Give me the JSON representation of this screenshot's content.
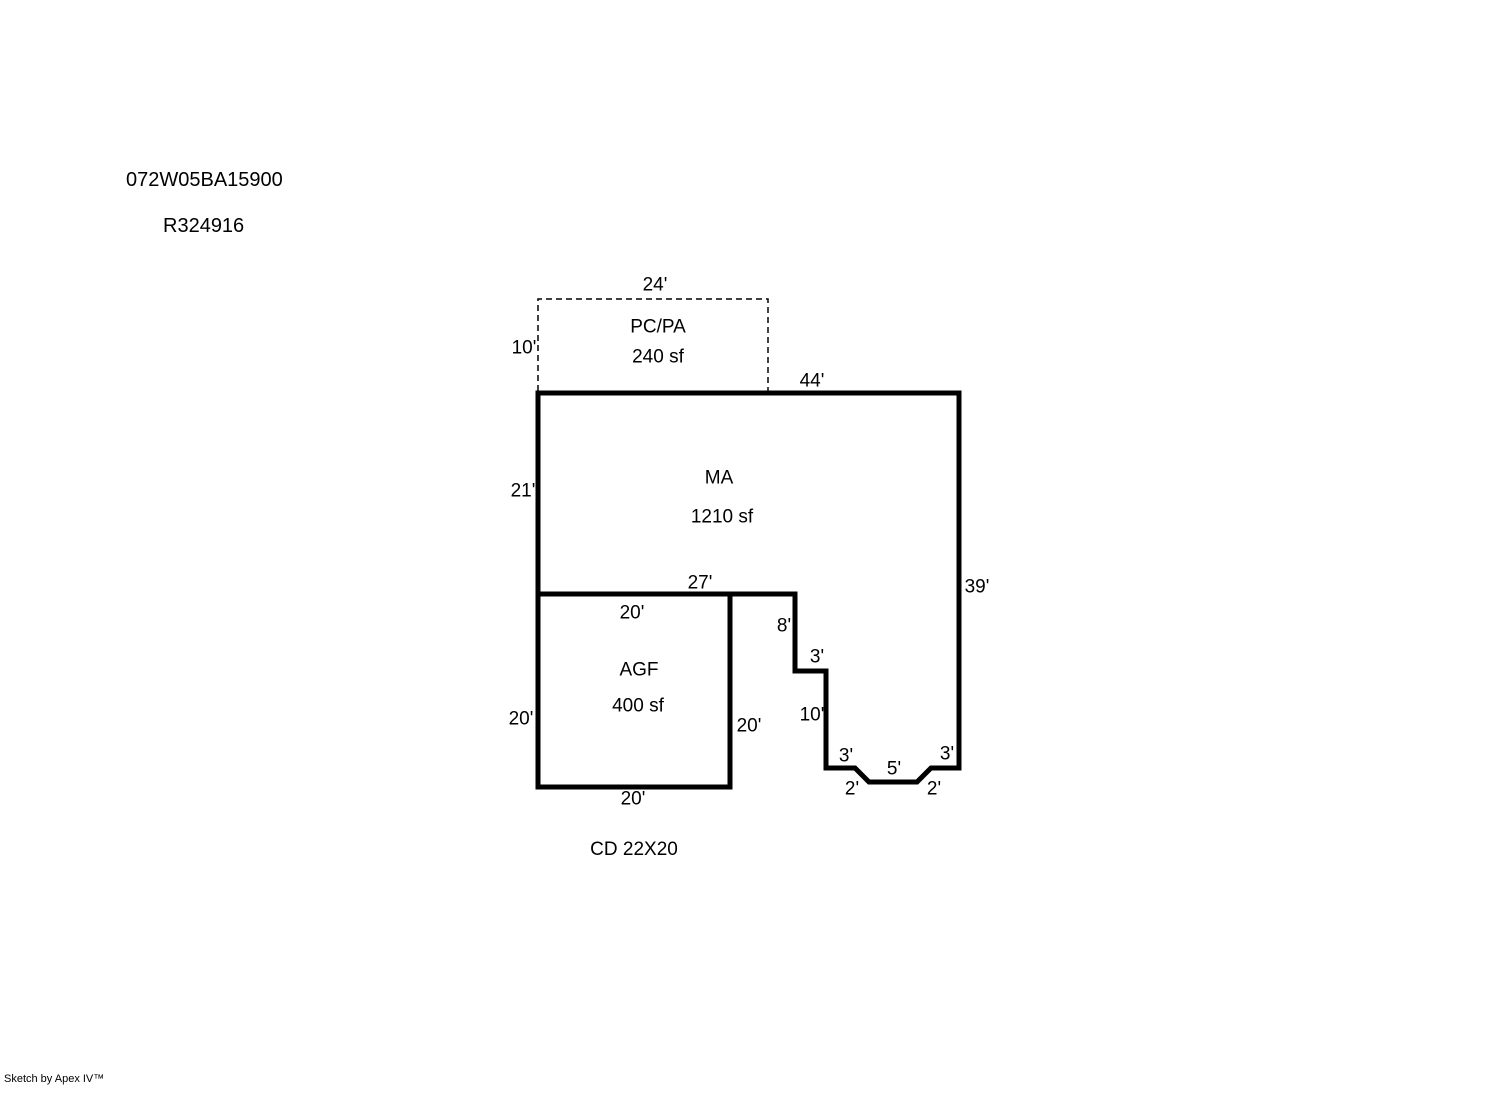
{
  "header": {
    "parcel_number": "072W05BA15900",
    "record_number": "R324916"
  },
  "footer": {
    "note": "CD 22X20",
    "credit": "Sketch by Apex IV™"
  },
  "sketch": {
    "line_color": "#000000",
    "background_color": "#ffffff",
    "areas": {
      "pcpa": {
        "label": "PC/PA",
        "area": "240 sf",
        "dims": {
          "top": "24'",
          "left": "10'"
        }
      },
      "ma": {
        "label": "MA",
        "area": "1210 sf",
        "dims": {
          "top": "44'",
          "left": "21'",
          "right": "39'",
          "bottom": "27'"
        }
      },
      "agf": {
        "label": "AGF",
        "area": "400 sf",
        "dims": {
          "top": "20'",
          "left": "20'",
          "right": "20'",
          "bottom": "20'"
        }
      },
      "steps": {
        "s8": "8'",
        "s3a": "3'",
        "s10": "10'",
        "s3b": "3'",
        "s5": "5'",
        "s3c": "3'",
        "s2a": "2'",
        "s2b": "2'"
      }
    }
  }
}
